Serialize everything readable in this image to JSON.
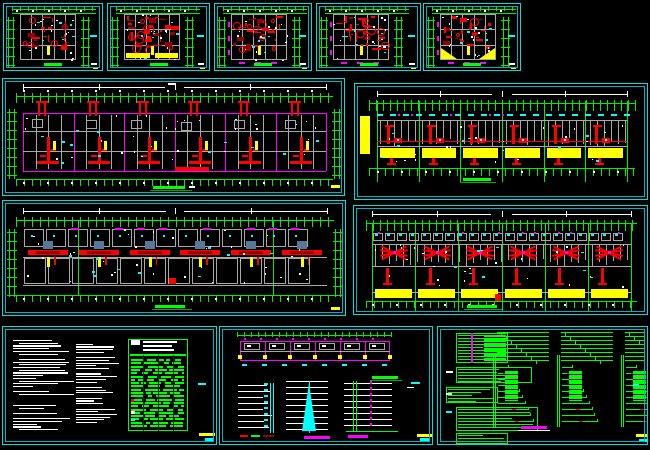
{
  "app": {
    "kind": "cad-drawing-canvas",
    "background": "#000000",
    "width": 650,
    "height": 450
  },
  "colors": {
    "border": "#00dede",
    "borderInner": "#00b4c4",
    "green": "#00ee00",
    "titleGreen": "#00ff00",
    "underGreen": "#00aa00",
    "gray": "#a8a8a8",
    "darkGray": "#787878",
    "red": "#ff0000",
    "darkRed": "#9b0000",
    "yellow": "#ffff00",
    "magenta": "#ff00ff",
    "white": "#ffffff",
    "cyan": "#00ffff",
    "slate": "#56789a"
  },
  "panels": [
    {
      "id": "tp1",
      "name": "unit-floor-plan-1",
      "type": "smallPlan",
      "x": 3,
      "y": 3,
      "w": 100,
      "h": 68,
      "seed": 1,
      "features": {
        "redDensity": 22,
        "yellowBand": false,
        "yellowCorners": false,
        "magentaEdge": false
      }
    },
    {
      "id": "tp2",
      "name": "unit-floor-plan-2",
      "type": "smallPlan",
      "x": 107,
      "y": 3,
      "w": 103,
      "h": 68,
      "seed": 2,
      "features": {
        "redDensity": 36,
        "yellowBand": true,
        "yellowCorners": false,
        "magentaEdge": false
      }
    },
    {
      "id": "tp3",
      "name": "unit-floor-plan-3",
      "type": "smallPlan",
      "x": 214,
      "y": 3,
      "w": 98,
      "h": 68,
      "seed": 3,
      "features": {
        "redDensity": 32,
        "yellowBand": false,
        "yellowCorners": false,
        "magentaEdge": true
      }
    },
    {
      "id": "tp4",
      "name": "unit-floor-plan-4",
      "type": "smallPlan",
      "x": 316,
      "y": 3,
      "w": 105,
      "h": 68,
      "seed": 4,
      "features": {
        "redDensity": 32,
        "yellowBand": false,
        "yellowCorners": false,
        "magentaEdge": true
      }
    },
    {
      "id": "tp5",
      "name": "unit-floor-plan-5",
      "type": "smallPlan",
      "x": 423,
      "y": 3,
      "w": 98,
      "h": 68,
      "seed": 5,
      "features": {
        "redDensity": 26,
        "yellowBand": false,
        "yellowCorners": true,
        "magentaEdge": true
      }
    },
    {
      "id": "r2l",
      "name": "ground-floor-plumbing-plan",
      "type": "longPlanA",
      "x": 2,
      "y": 78,
      "w": 343,
      "h": 118,
      "seed": 6,
      "units": 6
    },
    {
      "id": "r2r",
      "name": "standard-floor-plumbing-plan",
      "type": "longPlanB",
      "x": 354,
      "y": 83,
      "w": 294,
      "h": 117,
      "seed": 7,
      "units": 6
    },
    {
      "id": "r3l",
      "name": "ground-floor-electrical-plan",
      "type": "longPlanC",
      "x": 2,
      "y": 200,
      "w": 344,
      "h": 116,
      "seed": 8,
      "units": 6
    },
    {
      "id": "r3r",
      "name": "standard-floor-electrical-plan",
      "type": "longPlanD",
      "x": 353,
      "y": 205,
      "w": 295,
      "h": 110,
      "seed": 9,
      "units": 6
    },
    {
      "id": "b1",
      "name": "design-notes-and-material-table",
      "type": "notes",
      "x": 2,
      "y": 326,
      "w": 215,
      "h": 119,
      "seed": 10
    },
    {
      "id": "b2",
      "name": "roof-plan-and-riser-diagrams",
      "type": "elevation",
      "x": 219,
      "y": 326,
      "w": 214,
      "h": 119,
      "seed": 11
    },
    {
      "id": "b3",
      "name": "power-distribution-system-diagrams",
      "type": "electrical",
      "x": 437,
      "y": 326,
      "w": 211,
      "h": 119,
      "seed": 12
    }
  ]
}
